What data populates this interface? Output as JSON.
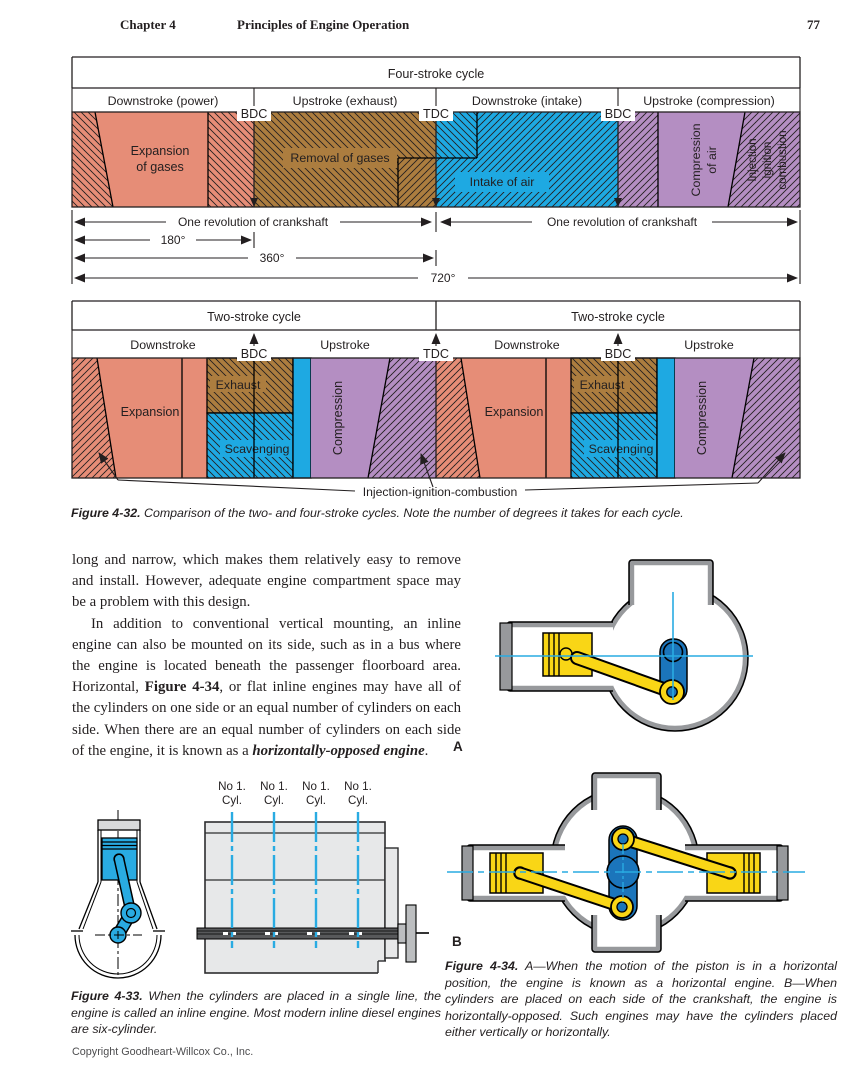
{
  "header": {
    "chapter": "Chapter 4",
    "title": "Principles of Engine Operation",
    "page_number": "77"
  },
  "figure32": {
    "four_stroke": {
      "title": "Four-stroke cycle",
      "col1": "Downstroke (power)",
      "col2": "Upstroke (exhaust)",
      "col3": "Downstroke (intake)",
      "col4": "Upstroke (compression)",
      "marker_bdc1": "BDC",
      "marker_tdc": "TDC",
      "marker_bdc2": "BDC",
      "expansion_l1": "Expansion",
      "expansion_l2": "of gases",
      "removal": "Removal of gases",
      "intake": "Intake of air",
      "compression_l1": "Compression",
      "compression_l2": "of air",
      "injection_l1": "Injection",
      "injection_l2": "ignition",
      "injection_l3": "combustion",
      "rev_left": "One revolution of crankshaft",
      "rev_right": "One revolution of crankshaft",
      "deg180": "180°",
      "deg360": "360°",
      "deg720": "720°"
    },
    "two_stroke": {
      "title_left": "Two-stroke cycle",
      "title_right": "Two-stroke cycle",
      "down_left": "Downstroke",
      "up_left": "Upstroke",
      "down_right": "Downstroke",
      "up_right": "Upstroke",
      "bdc_left": "BDC",
      "tdc": "TDC",
      "bdc_right": "BDC",
      "expansion_left": "Expansion",
      "exhaust_left": "Exhaust",
      "scavenging_left": "Scavenging",
      "compression_left": "Compression",
      "expansion_right": "Expansion",
      "exhaust_right": "Exhaust",
      "scavenging_right": "Scavenging",
      "compression_right": "Compression",
      "leader_label": "Injection-ignition-combustion"
    },
    "caption_lead": "Figure 4-32.",
    "caption_rest": " Comparison of the two- and four-stroke cycles. Note the number of degrees it takes for each cycle."
  },
  "body": {
    "p1": "long and narrow, which makes them relatively easy to remove and install. However, adequate engine compartment space may be a problem with this design.",
    "p2_pre": "In addition to conventional vertical mounting, an inline engine can also be mounted on its side, such as in a bus where the engine is located beneath the passenger floorboard area. Horizontal, ",
    "p2_figref": "Figure 4-34",
    "p2_mid": ", or flat inline engines may have all of the cylinders on one side or an equal number of cylinders on each side. When there are an equal number of cylinders on each side of the engine, it is known as a ",
    "p2_term": "horizontally-opposed engine",
    "p2_end": "."
  },
  "figure33": {
    "cyl1_l1": "No 1.",
    "cyl1_l2": "Cyl.",
    "cyl2_l1": "No 1.",
    "cyl2_l2": "Cyl.",
    "cyl3_l1": "No 1.",
    "cyl3_l2": "Cyl.",
    "cyl4_l1": "No 1.",
    "cyl4_l2": "Cyl.",
    "caption_lead": "Figure 4-33.",
    "caption_rest": " When the cylinders are placed in a single line, the engine is called an inline engine. Most modern inline diesel engines are six-cylinder."
  },
  "figure34": {
    "label_a": "A",
    "label_b": "B",
    "caption_lead": "Figure 4-34.",
    "caption_rest": " A—When the motion of the piston is in a horizontal position, the engine is known as a horizontal engine. B—When cylinders are placed on each side of the crankshaft, the engine is horizontally-opposed. Such engines may have the cylinders placed either vertically or horizontally."
  },
  "footer": {
    "copyright": "Copyright Goodheart-Willcox Co., Inc."
  },
  "palette": {
    "salmon": "#e68d77",
    "brown": "#ac7d3f",
    "blue": "#1ea9e2",
    "purple": "#b48ec2",
    "yellow": "#f9d616",
    "crank_blue": "#1b75bb",
    "cyan_line": "#29abe2",
    "block_gray": "#e7e8e9",
    "outline_gray": "#97999c"
  }
}
